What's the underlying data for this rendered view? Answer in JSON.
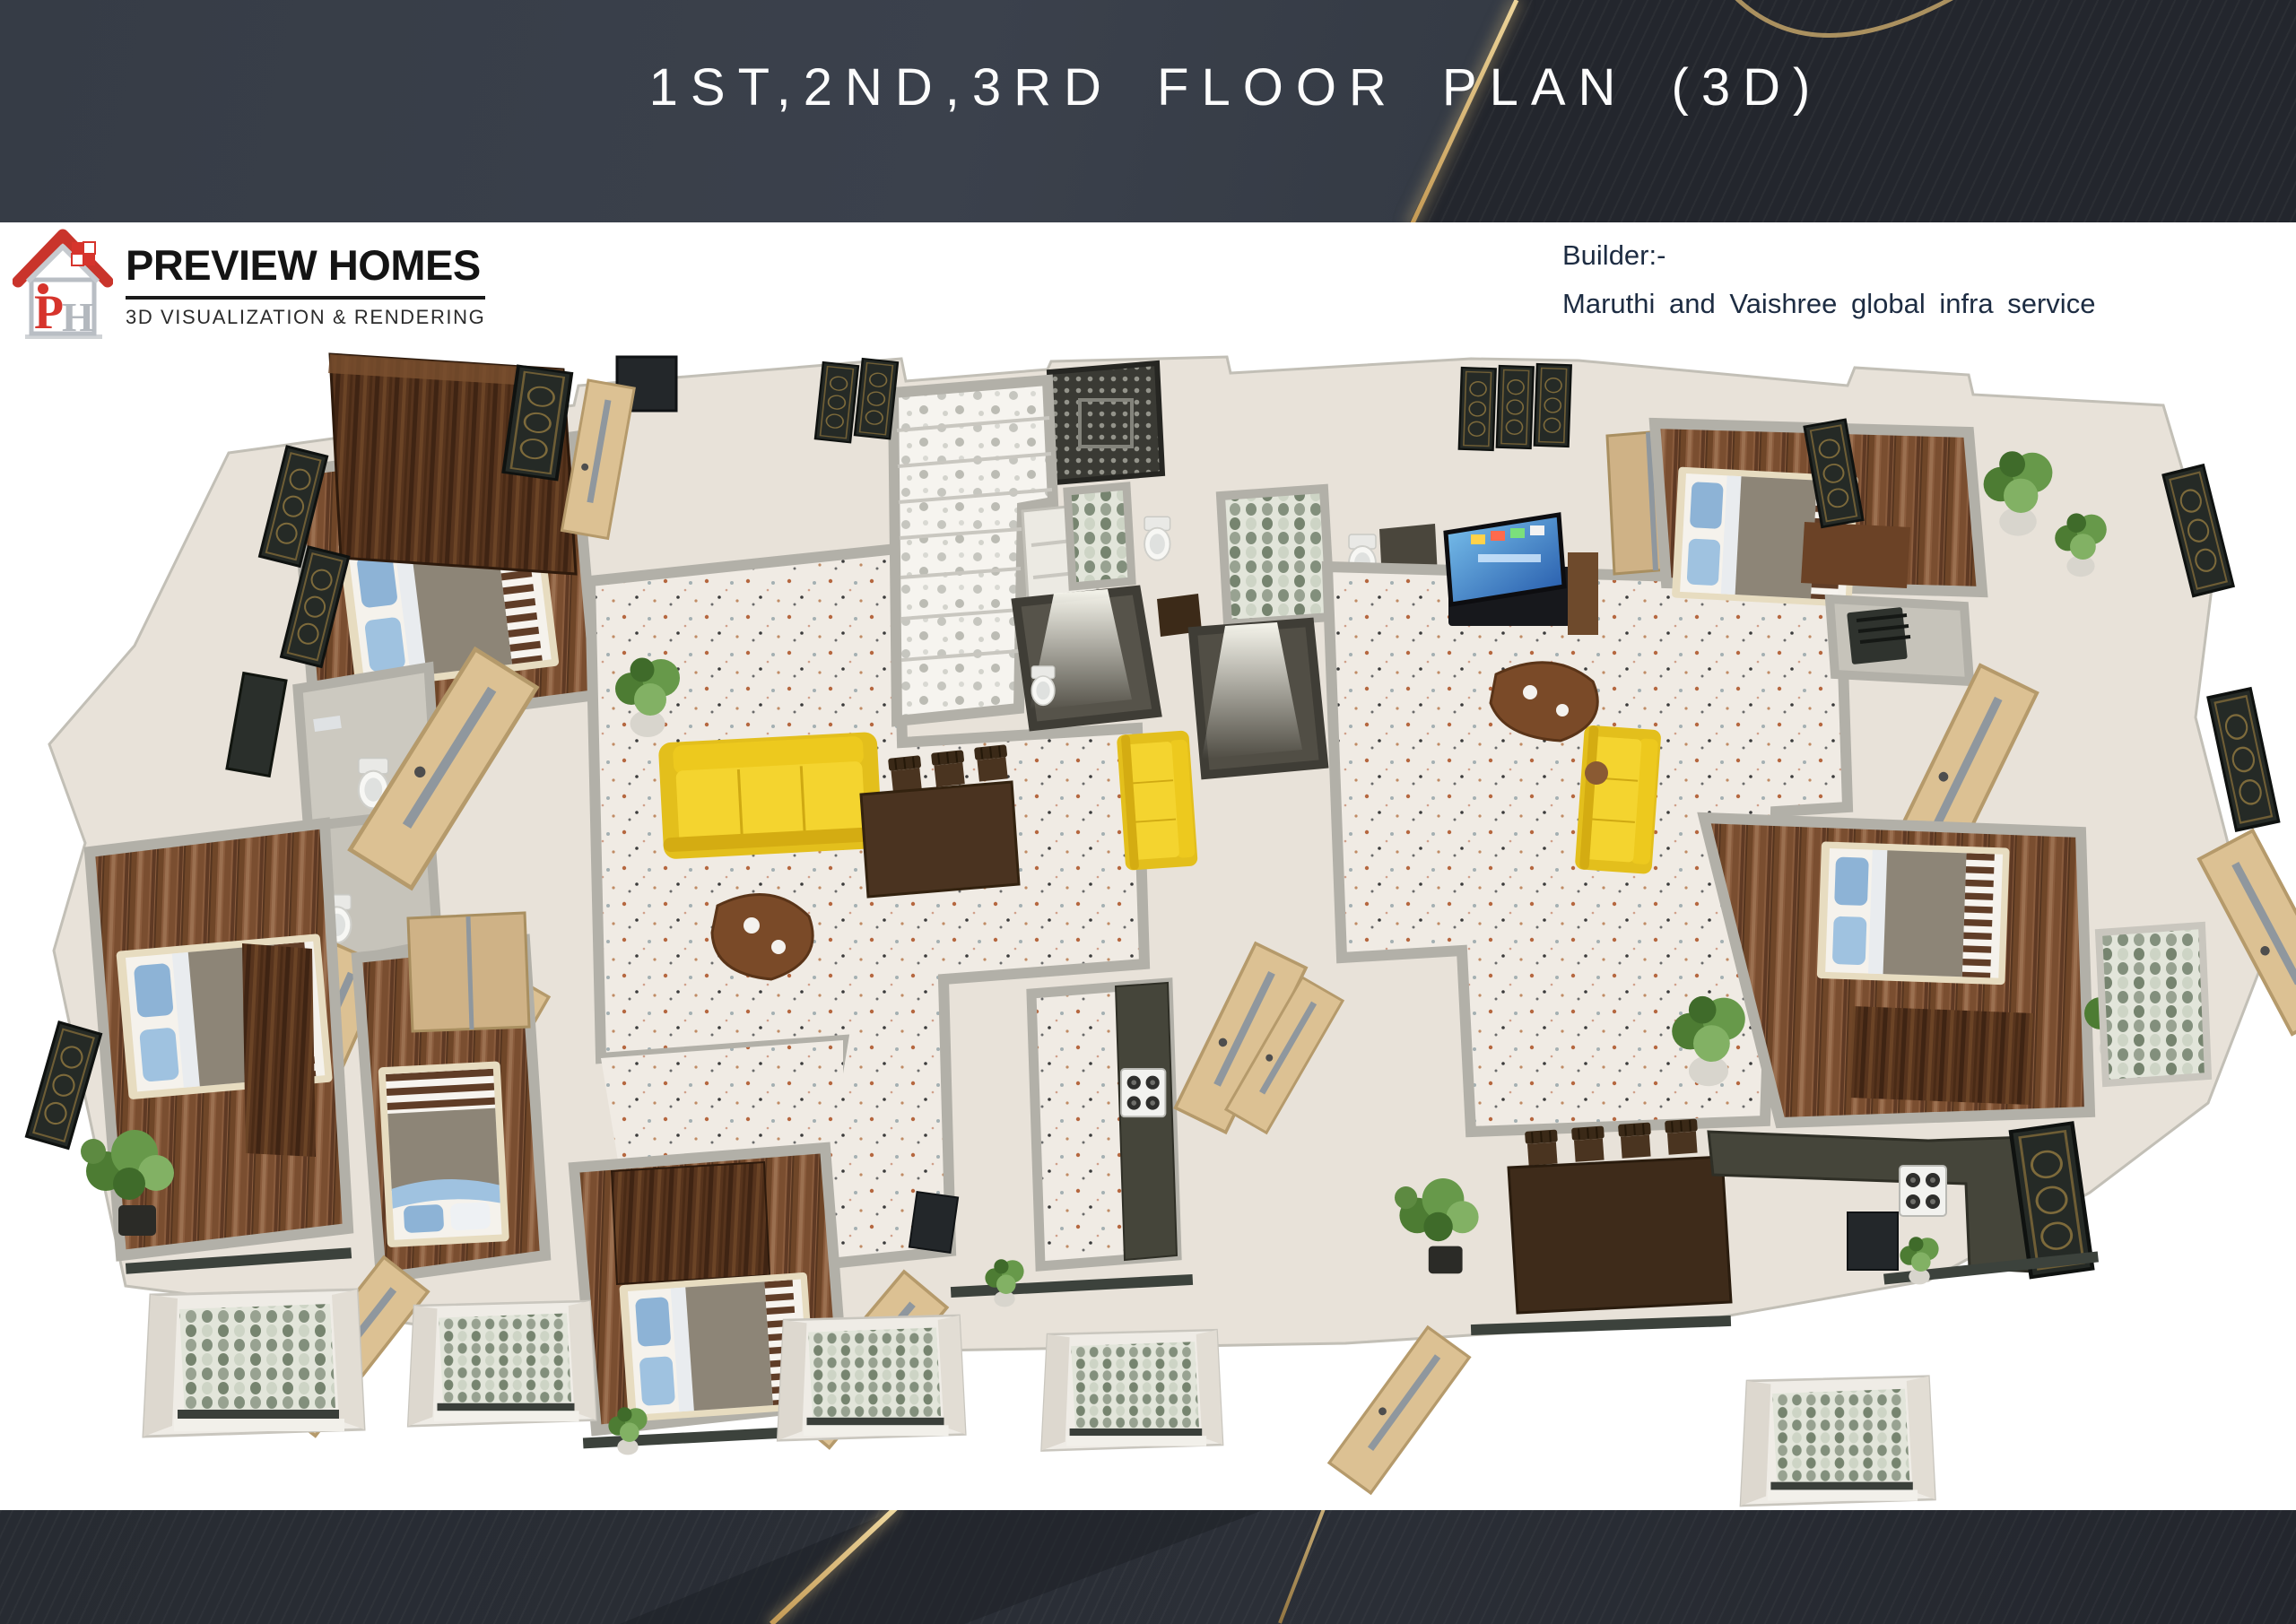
{
  "header": {
    "title": "1ST,2ND,3RD FLOOR PLAN  (3D)"
  },
  "logo": {
    "company": "PREVIEW HOMES",
    "tagline": "3D VISUALIZATION & RENDERING",
    "monogram_p": "P",
    "monogram_h": "H"
  },
  "builder": {
    "label": "Builder:-",
    "name": "Maruthi and Vaishree global infra service"
  },
  "palette": {
    "header_dark": "#343a44",
    "header_wedge": "#23262d",
    "accent_gold": "#c9a662",
    "title_white": "#fcfcfc",
    "logo_red": "#d6342c",
    "logo_silver": "#b3b8be",
    "builder_navy": "#1d2c42",
    "wall_face": "#e8e2d9",
    "wall_top": "#b2b0a8",
    "terrazzo": "#f0ebe4",
    "wood_floor": "#8a5c3d",
    "wood_dark": "#57341d",
    "door_wood": "#dcc193",
    "sofa_yellow": "#f2cf2a",
    "bed_blanket": "#8d8577",
    "pillow_blue": "#8db3d6",
    "counter_green": "#45453a",
    "bath_dark": "#56534a",
    "stair_white": "#f6f4ef",
    "balcony_tile": "#8b988b",
    "plant_green": "#5d8a41",
    "tv_screen_blue": "#2f6fc0"
  }
}
